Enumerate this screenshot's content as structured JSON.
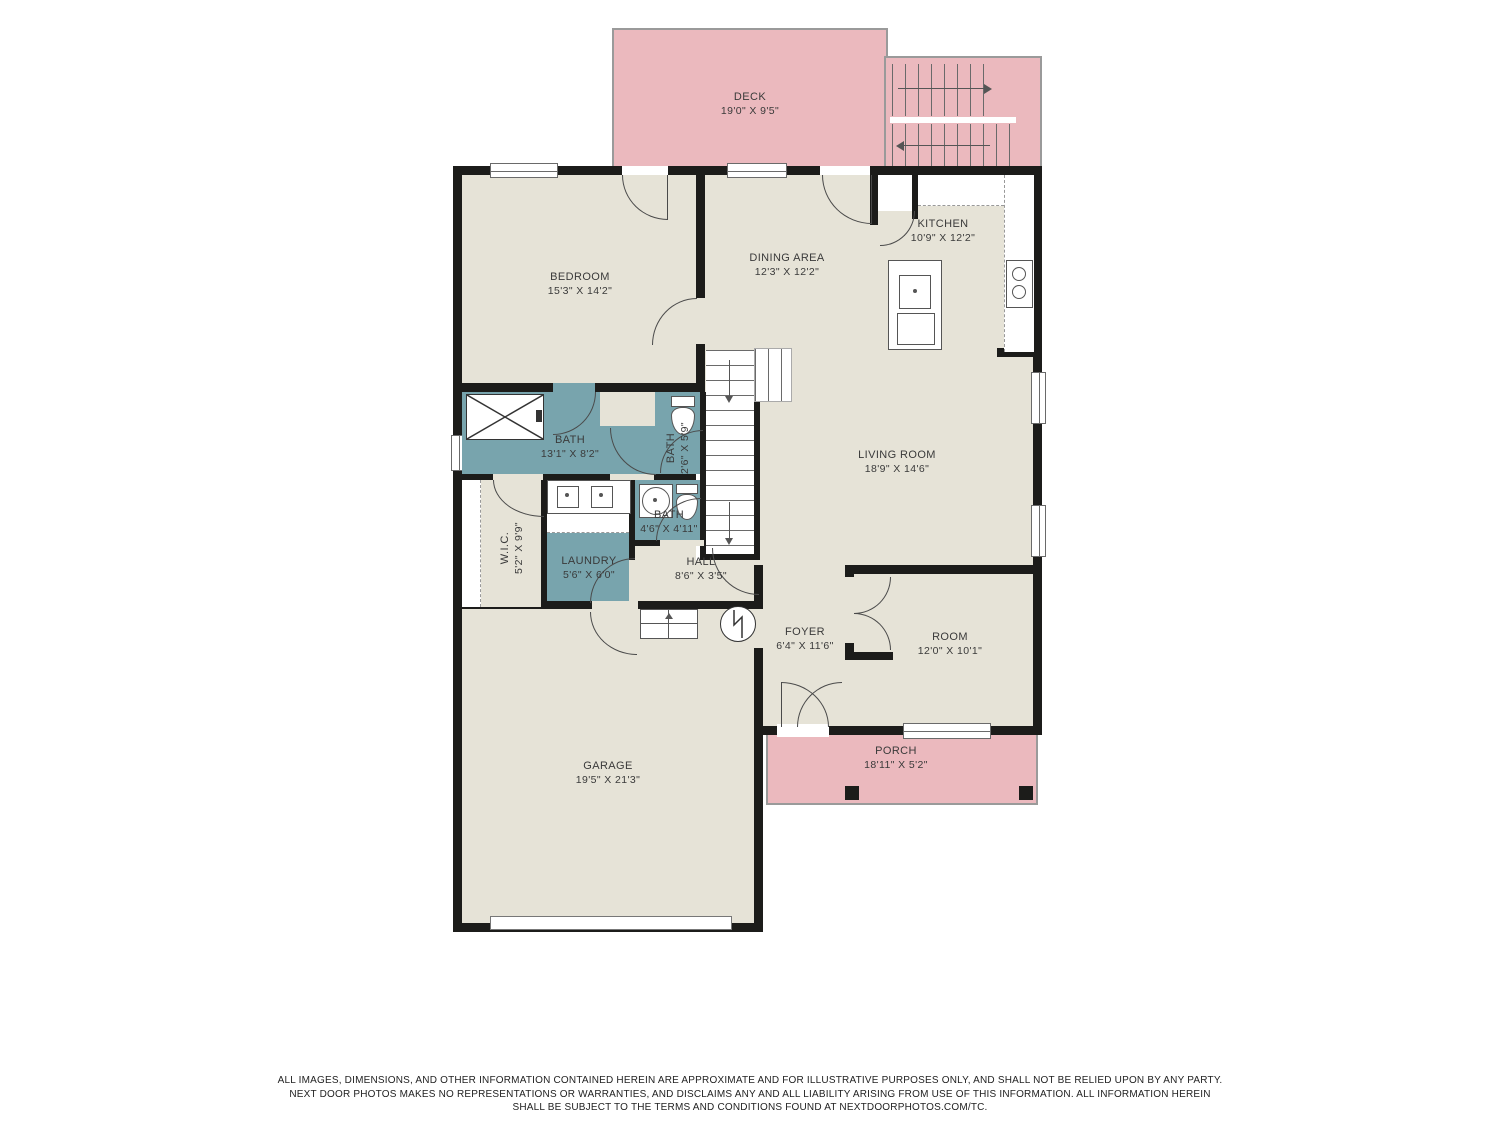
{
  "rooms": {
    "deck": {
      "name": "DECK",
      "dims": "19'0\" X 9'5\""
    },
    "bedroom": {
      "name": "BEDROOM",
      "dims": "15'3\" X 14'2\""
    },
    "dining": {
      "name": "DINING AREA",
      "dims": "12'3\" X 12'2\""
    },
    "kitchen": {
      "name": "KITCHEN",
      "dims": "10'9\" X 12'2\""
    },
    "living": {
      "name": "LIVING ROOM",
      "dims": "18'9\" X 14'6\""
    },
    "bath_main": {
      "name": "BATH",
      "dims": "13'1\" X 8'2\""
    },
    "bath_small": {
      "name": "BATH",
      "dims": "2'6\" X 5'9\""
    },
    "bath_half": {
      "name": "BATH",
      "dims": "4'6\" X 4'11\""
    },
    "wic": {
      "name": "W.I.C.",
      "dims": "5'2\" X 9'9\""
    },
    "laundry": {
      "name": "LAUNDRY",
      "dims": "5'6\" X 6'0\""
    },
    "hall": {
      "name": "HALL",
      "dims": "8'6\" X 3'5\""
    },
    "foyer": {
      "name": "FOYER",
      "dims": "6'4\" X 11'6\""
    },
    "room": {
      "name": "ROOM",
      "dims": "12'0\" X 10'1\""
    },
    "porch": {
      "name": "PORCH",
      "dims": "18'11\" X 5'2\""
    },
    "garage": {
      "name": "GARAGE",
      "dims": "19'5\" X 21'3\""
    }
  },
  "disclaimer": {
    "line1": "ALL IMAGES, DIMENSIONS, AND OTHER INFORMATION CONTAINED HEREIN ARE APPROXIMATE AND FOR ILLUSTRATIVE PURPOSES ONLY, AND SHALL NOT BE RELIED UPON BY ANY PARTY.",
    "line2": "NEXT DOOR PHOTOS MAKES NO REPRESENTATIONS OR WARRANTIES, AND DISCLAIMS ANY AND ALL LIABILITY ARISING FROM USE OF THIS INFORMATION. ALL INFORMATION HEREIN",
    "line3": "SHALL BE SUBJECT TO THE TERMS AND CONDITIONS FOUND AT NEXTDOORPHOTOS.COM/TC."
  },
  "colors": {
    "wall": "#1c1c1a",
    "floor": "#e6e3d7",
    "wet_room": "#78a4ad",
    "outdoor": "#ebb9be"
  }
}
